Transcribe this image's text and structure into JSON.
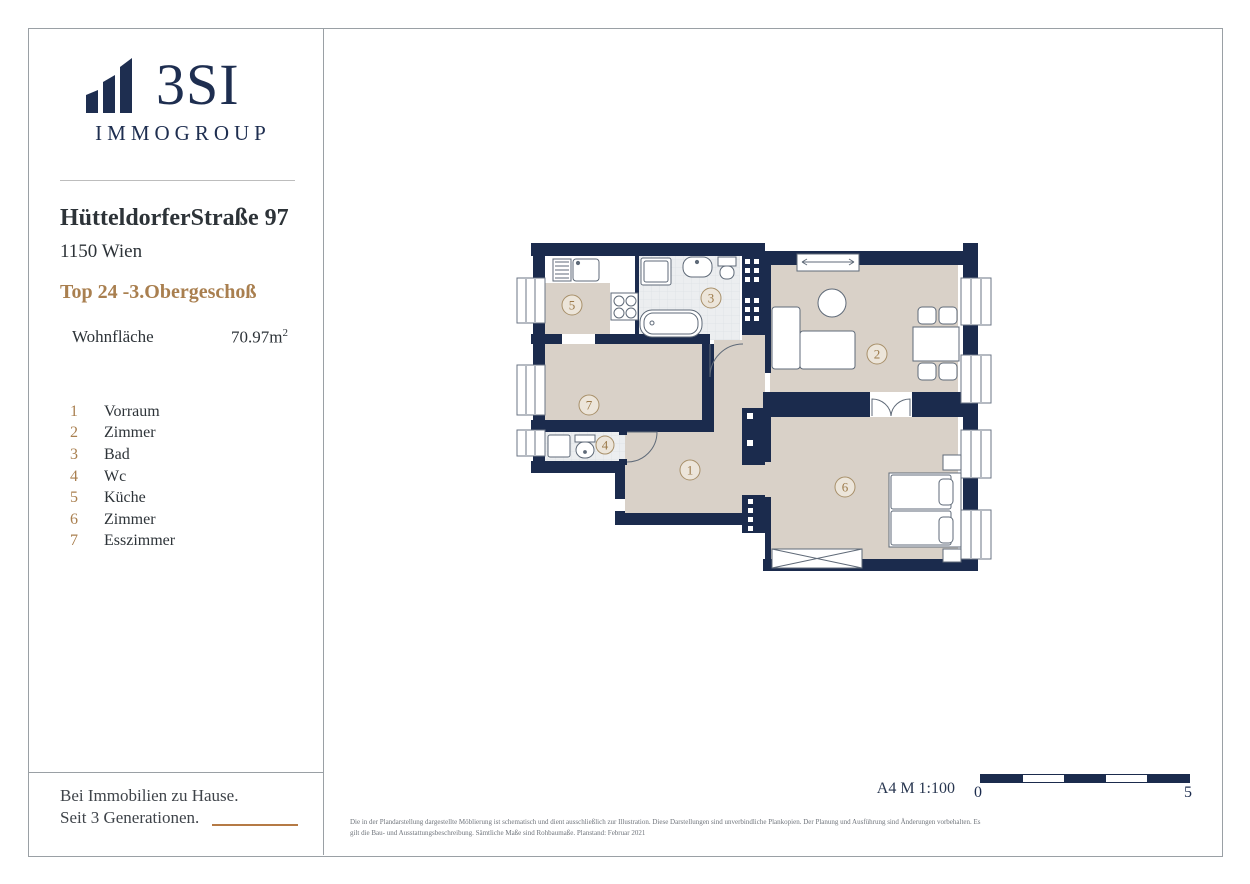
{
  "sidebar": {
    "brand": "3SI",
    "brand_sub": "IMMOGROUP",
    "address_line1": "HütteldorferStraße 97",
    "address_line2": "1150 Wien",
    "unit_title": "Top 24 -3.Obergeschoß",
    "area": {
      "label": "Wohnfläche",
      "value": "70.97m",
      "superscript": "2"
    },
    "legend": [
      {
        "number": "1",
        "label": "Vorraum"
      },
      {
        "number": "2",
        "label": "Zimmer"
      },
      {
        "number": "3",
        "label": "Bad"
      },
      {
        "number": "4",
        "label": "Wc"
      },
      {
        "number": "5",
        "label": "Küche"
      },
      {
        "number": "6",
        "label": "Zimmer"
      },
      {
        "number": "7",
        "label": "Esszimmer"
      }
    ],
    "tagline_line1": "Bei Immobilien zu Hause.",
    "tagline_line2": "Seit 3 Generationen."
  },
  "plan": {
    "rooms": [
      {
        "number": "1",
        "name": "Vorraum"
      },
      {
        "number": "2",
        "name": "Zimmer"
      },
      {
        "number": "3",
        "name": "Bad"
      },
      {
        "number": "4",
        "name": "Wc"
      },
      {
        "number": "5",
        "name": "Küche"
      },
      {
        "number": "6",
        "name": "Zimmer"
      },
      {
        "number": "7",
        "name": "Esszimmer"
      }
    ]
  },
  "footer": {
    "format_and_scale": "A4  M 1:100",
    "scale_start": "0",
    "scale_end": "5",
    "disclaimer": "Die in der Plandarstellung dargestellte Möblierung ist schematisch und dient ausschließlich zur Illustration. Diese Darstellungen sind unverbindliche Plankopien. Der Planung und Ausführung sind Änderungen vorbehalten. Es gilt die Bau- und Ausstattungsbeschreibung. Sämtliche Maße sind Rohbaumaße. Planstand: Februar 2021"
  },
  "colors": {
    "wall_navy": "#1b2b4d",
    "accent_tan": "#a97f4f",
    "floor_beige": "#d9d1c8",
    "tile_gray": "#eceef0"
  }
}
